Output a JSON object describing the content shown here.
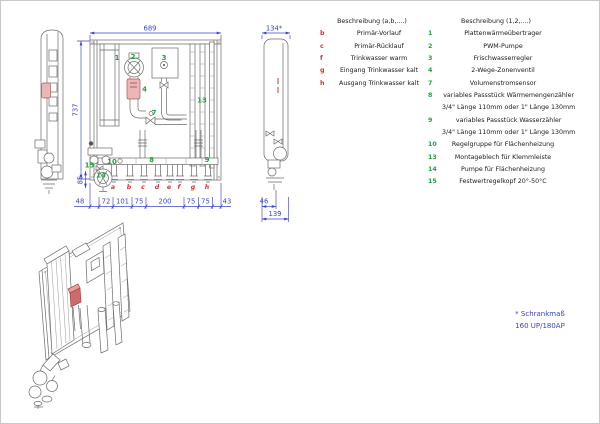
{
  "legend_letters": {
    "header": "Beschreibung (a,b,....)",
    "rows": [
      {
        "key": "b",
        "label": "Primär-Vorlauf"
      },
      {
        "key": "c",
        "label": "Primär-Rücklauf"
      },
      {
        "key": "f",
        "label": "Trinkwasser warm"
      },
      {
        "key": "g",
        "label": "Eingang Trinkwasser kalt"
      },
      {
        "key": "h",
        "label": "Ausgang Trinkwasser kalt"
      }
    ]
  },
  "legend_numbers": {
    "header": "Beschreibung (1,2,....)",
    "rows": [
      {
        "key": "1",
        "label": "Plattenwärmeübertrager"
      },
      {
        "key": "2",
        "label": "PWM-Pumpe"
      },
      {
        "key": "3",
        "label": "Frischwasserregler"
      },
      {
        "key": "4",
        "label": "2-Wege-Zonenventil"
      },
      {
        "key": "7",
        "label": "Volumenstromsensor"
      },
      {
        "key": "8",
        "label": "variables Passstück Wärmemengenzähler",
        "label2": "3/4\" Länge 110mm oder 1\" Länge 130mm"
      },
      {
        "key": "9",
        "label": "variables Passstück Wasserzähler",
        "label2": "3/4\" Länge 110mm oder 1\" Länge 130mm"
      },
      {
        "key": "10",
        "label": "Regelgruppe für Flächenheizung"
      },
      {
        "key": "13",
        "label": "Montageblech für Klemmleiste"
      },
      {
        "key": "14",
        "label": "Pumpe für Flächenheizung"
      },
      {
        "key": "15",
        "label": "Festwertregelkopf 20°-50°C"
      }
    ]
  },
  "drawing": {
    "dims": {
      "front_width": "689",
      "side_width": "134*",
      "front_height": "737",
      "pump_height": "86",
      "chain": [
        "48",
        "72",
        "101",
        "75",
        "200",
        "75",
        "75",
        "43"
      ],
      "side_depth": "46",
      "side_length": "139"
    },
    "parts": {
      "p1": "1",
      "p2": "2",
      "p3": "3",
      "p4": "4",
      "p7": "7",
      "p8": "8",
      "p9": "9",
      "p10": "10",
      "p13": "13",
      "p14": "14",
      "p15": "15"
    },
    "letters": [
      "a",
      "b",
      "c",
      "d",
      "e",
      "f",
      "g",
      "h"
    ]
  },
  "note": {
    "line1": "* Schrankmaß",
    "line2": "160 UP/180AP"
  },
  "colors": {
    "dimension": "#3a46c8",
    "part_number": "#1fa53a",
    "connection_letter": "#cc3333",
    "highlight": "#eab7b7"
  }
}
